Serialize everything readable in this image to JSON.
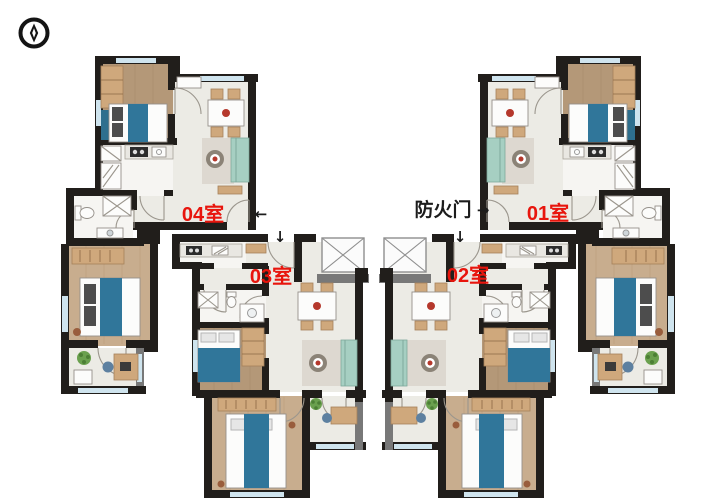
{
  "page": {
    "background": "#ffffff"
  },
  "compass": {
    "icon": "compass-north-icon"
  },
  "units": [
    {
      "id": "04",
      "label": "04室"
    },
    {
      "id": "03",
      "label": "03室"
    },
    {
      "id": "02",
      "label": "02室"
    },
    {
      "id": "01",
      "label": "01室"
    }
  ],
  "annotations": {
    "fire_door": "防火门",
    "arrow_left": "←",
    "arrow_right": "→",
    "arrow_down": "↓"
  },
  "colors": {
    "unit_label": "#e8150d",
    "annotation": "#1c1c1c",
    "wall": "#211e1b",
    "window": "#cfe4ee",
    "floor": "#ecebe5",
    "wood_light": "#b49878",
    "wood_warm": "#c8ad8e",
    "bed_blue": "#30769a",
    "sofa_teal": "#a6cfc2",
    "furniture_tan": "#cfa87c"
  }
}
